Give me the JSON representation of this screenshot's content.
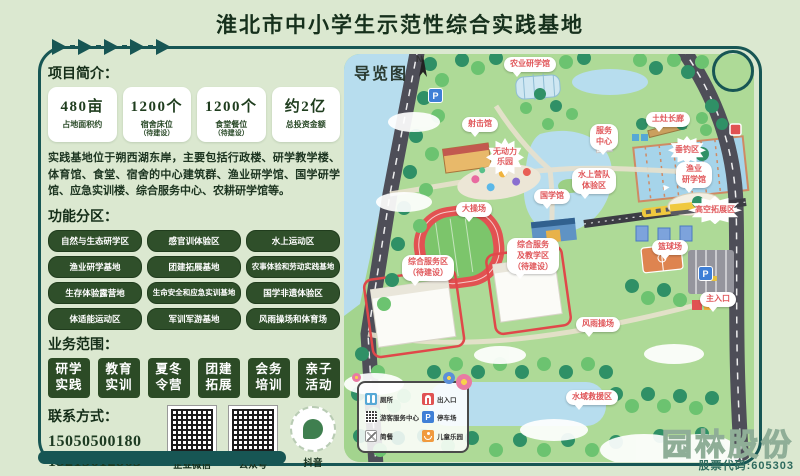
{
  "title": "淮北市中小学生示范性综合实践基地",
  "intro": {
    "heading": "项目简介：",
    "stats": [
      {
        "value": "480亩",
        "label": "占地面积约",
        "note": ""
      },
      {
        "value": "1200个",
        "label": "宿舍床位",
        "note": "（待建设）"
      },
      {
        "value": "1200个",
        "label": "食堂餐位",
        "note": "（待建设）"
      },
      {
        "value": "约2亿",
        "label": "总投资金额",
        "note": ""
      }
    ],
    "description": "实践基地位于朔西湖东岸，主要包括行政楼、研学教学楼、体育馆、食堂、宿舍的中心建筑群、渔业研学馆、国学研学馆、应急实训楼、综合服务中心、农耕研学馆等。"
  },
  "zones": {
    "heading": "功能分区：",
    "items": [
      "自然与生态研学区",
      "感官训体验区",
      "水上运动区",
      "渔业研学基地",
      "团建拓展基地",
      "农事体验和劳动实践基地",
      "生存体验露营地",
      "生命安全和应急实训基地",
      "国学非遗体验区",
      "体适能运动区",
      "军训军游基地",
      "风雨操场和体育场"
    ]
  },
  "business": {
    "heading": "业务范围：",
    "items": [
      {
        "top": "研学",
        "bot": "实践"
      },
      {
        "top": "教育",
        "bot": "实训"
      },
      {
        "top": "夏冬",
        "bot": "令营"
      },
      {
        "top": "团建",
        "bot": "拓展"
      },
      {
        "top": "会务",
        "bot": "培训"
      },
      {
        "top": "亲子",
        "bot": "活动"
      }
    ]
  },
  "contact": {
    "heading": "联系方式：",
    "phones": [
      "15050500180",
      "15215612863"
    ],
    "qr_labels": [
      "企业微信",
      "公众号",
      "抖音"
    ]
  },
  "map": {
    "title": "导览图",
    "compass_letter": "N",
    "parking_letter": "P",
    "labels": [
      "农业研学馆",
      "射击馆",
      "无动力\n乐园",
      "土灶长廊",
      "服务\n中心",
      "垂钓区",
      "渔业\n研学馆",
      "水上营队\n体验区",
      "国学馆",
      "大操场",
      "综合服务区\n（待建设）",
      "综合服务\n及教学区\n（待建设）",
      "高空拓展区",
      "篮球场",
      "主入口",
      "风雨操场",
      "水域救援区"
    ],
    "legend": [
      "厕所",
      "出入口",
      "游客服务中心",
      "停车场",
      "简餐",
      "儿童乐园"
    ]
  },
  "watermark": {
    "name": "园林股份",
    "code": "股票代码:605303"
  },
  "colors": {
    "frame": "#175654",
    "pill": "#2f4f2a",
    "block": "#2c4b26",
    "label_red": "#e0575a",
    "bg": "#dbe8d0"
  }
}
